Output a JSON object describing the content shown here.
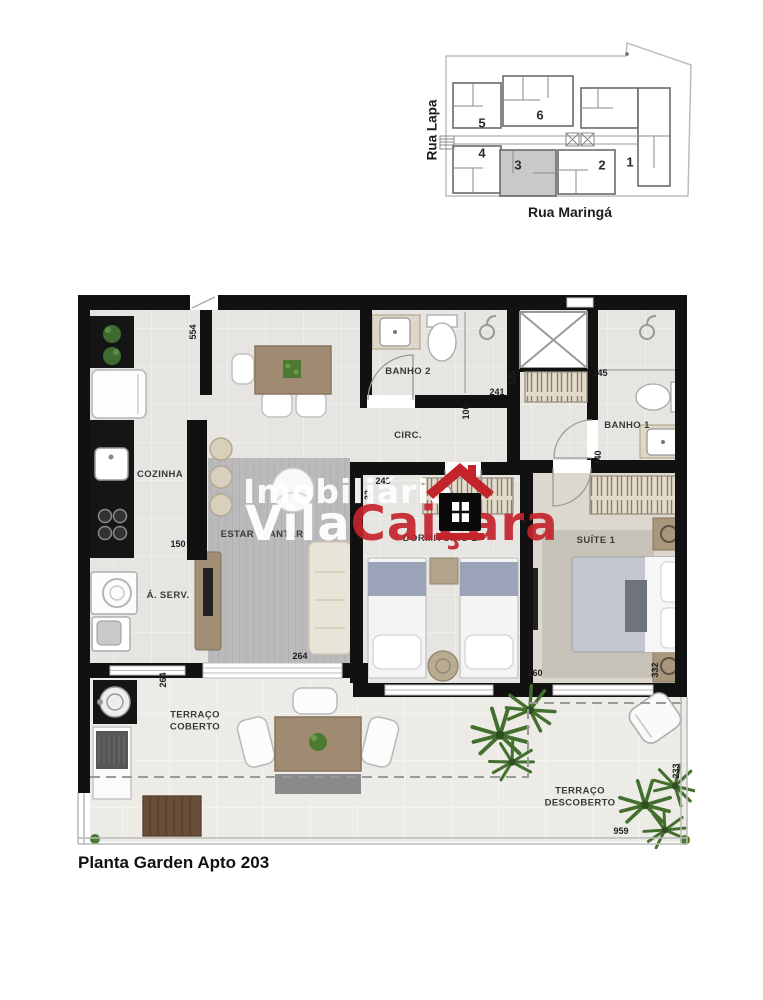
{
  "page": {
    "caption": "Planta Garden Apto 203"
  },
  "key_plan": {
    "street_left": "Rua Lapa",
    "street_bottom": "Rua Maringá",
    "highlighted_unit": "3",
    "units": [
      {
        "number": "1"
      },
      {
        "number": "2"
      },
      {
        "number": "3"
      },
      {
        "number": "4"
      },
      {
        "number": "5"
      },
      {
        "number": "6"
      }
    ]
  },
  "watermark": {
    "line1": "Imobiliária",
    "line2_white": "Vila",
    "line2_red": "Caiçara",
    "brand_red": "#c3242b",
    "icon": "house-logo"
  },
  "floor_plan": {
    "rooms": {
      "cozinha": "COZINHA",
      "area_servico": "Á. SERV.",
      "estar_jantar": "ESTAR / JANTAR",
      "banho2": "BANHO 2",
      "circ": "CIRC.",
      "banho1": "BANHO 1",
      "dormitorio1": "DORMITÓRIO 1",
      "suite1": "SUÍTE 1",
      "terraco_coberto_l1": "TERRAÇO",
      "terraco_coberto_l2": "COBERTO",
      "terraco_descoberto_l1": "TERRAÇO",
      "terraco_descoberto_l2": "DESCOBERTO"
    },
    "dimensions_cm": {
      "cozinha_depth": "554",
      "cozinha_pass": "150",
      "servico_depth": "264",
      "estar_width": "264",
      "banho2_width": "241",
      "banho2_side": "126",
      "circ_width": "100",
      "banho1_width": "145",
      "banho1_depth": "240",
      "dorm_width": "243",
      "dorm_wall": "32",
      "suite_width": "260",
      "suite_depth": "332",
      "terraco_depth": "233",
      "terraco_width": "959"
    },
    "colors": {
      "wall": "#111111",
      "floor": "#e7e5e2",
      "terrace_floor": "#edebe6",
      "rug_gray": "#bab9bb",
      "suite_rug": "#c8c3b8",
      "wood": "#a08b72",
      "wardrobe_hatch": "#e2dbcb",
      "accent_red": "#c3242b"
    }
  }
}
